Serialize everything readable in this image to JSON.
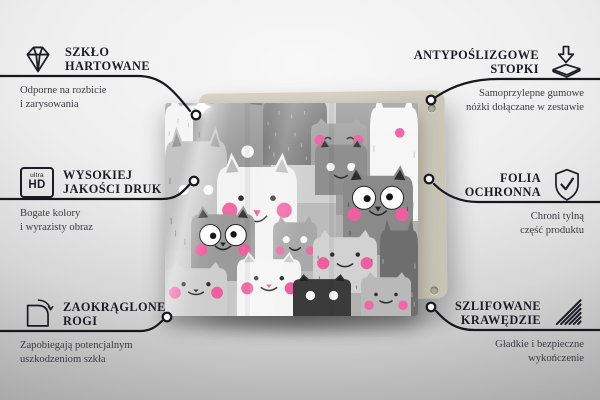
{
  "colors": {
    "title_text": "#1c1c24",
    "subtitle_text": "#3a3a41",
    "callout_line": "#17171c",
    "back_panel": "#d6d2c4",
    "accent_pink": "#ee5f9d",
    "backdrop_top": "#f8f8f8",
    "backdrop_bottom": "#a6a6a6"
  },
  "icons": {
    "ultra_hd": {
      "top": "ultra",
      "bottom": "HD"
    },
    "sparkle_glyph": "✦"
  },
  "features": {
    "left": [
      {
        "icon": "diamond-icon",
        "title_lines": [
          "SZKŁO",
          "HARTOWANE"
        ],
        "subtitle_lines": [
          "Odporne na rozbicie",
          "i zarysowania"
        ]
      },
      {
        "icon": "ultra-hd-icon",
        "title_lines": [
          "WYSOKIEJ",
          "JAKOŚCI DRUK"
        ],
        "subtitle_lines": [
          "Bogate kolory",
          "i wyrazisty obraz"
        ]
      },
      {
        "icon": "rounded-corner-icon",
        "title_lines": [
          "ZAOKRĄGLONE",
          "ROGI"
        ],
        "subtitle_lines": [
          "Zapobiegają potencjalnym",
          "uszkodzeniom szkła"
        ]
      }
    ],
    "right": [
      {
        "icon": "anti-slip-feet-icon",
        "title_lines": [
          "ANTYPOŚLIZGOWE",
          "STOPKI"
        ],
        "subtitle_lines": [
          "Samoprzylepne gumowe",
          "nóżki dołączane w zestawie"
        ]
      },
      {
        "icon": "shield-check-icon",
        "title_lines": [
          "FOLIA",
          "OCHRONNA"
        ],
        "subtitle_lines": [
          "Chroni tylną",
          "część produktu"
        ]
      },
      {
        "icon": "polished-edges-icon",
        "title_lines": [
          "SZLIFOWANE",
          "KRAWĘDZIE"
        ],
        "subtitle_lines": [
          "Gładkie i bezpieczne",
          "wykończenie"
        ]
      }
    ]
  },
  "product": {
    "pattern": {
      "pink": "#ee5f9d",
      "patches": [
        {
          "x": 0,
          "y": 0,
          "w": 253,
          "h": 213,
          "c": "#bcbcbc"
        },
        {
          "x": 0,
          "y": 0,
          "w": 85,
          "h": 92,
          "c": "#a9a9a9"
        },
        {
          "x": 85,
          "y": 0,
          "w": 86,
          "h": 100,
          "c": "#d0d0d0"
        },
        {
          "x": 171,
          "y": 0,
          "w": 82,
          "h": 112,
          "c": "#9e9e9e"
        },
        {
          "x": 0,
          "y": 92,
          "w": 80,
          "h": 121,
          "c": "#c7c7c7"
        },
        {
          "x": 171,
          "y": 112,
          "w": 82,
          "h": 101,
          "c": "#b1b1b1"
        }
      ],
      "cats": [
        {
          "x": 0,
          "y": -6,
          "w": 52,
          "h": 86,
          "c": "#f4f4f4",
          "ink": "#9a9a9a",
          "eyes": "none",
          "fur": true,
          "dense": true
        },
        {
          "x": 28,
          "y": -14,
          "w": 78,
          "h": 108,
          "c": "#9c9c9c",
          "ink": "#2f2f2f",
          "eyes": "whitedot",
          "eyeY": 0.58,
          "mouth": true,
          "fur": true,
          "earIn": "#6e6e6e"
        },
        {
          "x": 98,
          "y": -10,
          "w": 64,
          "h": 72,
          "c": "#7d7d7d",
          "ink": "#e8e8e8",
          "eyes": "none",
          "fur": true,
          "dense": true
        },
        {
          "x": 205,
          "y": -8,
          "w": 48,
          "h": 126,
          "c": "#f6f6f6",
          "ink": "#9a9a9a",
          "eyes": "none",
          "fur": true,
          "pinkdot": [
            0.62,
            0.3
          ]
        },
        {
          "x": 146,
          "y": 16,
          "w": 56,
          "h": 46,
          "c": "#a5a5a5",
          "ink": "#3a3a3a",
          "eyes": "closed",
          "eyeY": 0.42,
          "cheeks": "#ef63a0",
          "cheekY": 0.46
        },
        {
          "x": 150,
          "y": 36,
          "w": 52,
          "h": 56,
          "c": "#8f8f8f",
          "ink": "#2f2f2f",
          "eyes": "whitedot",
          "eyeY": 0.5,
          "mouth": true,
          "earIn": "#3c3c3c"
        },
        {
          "x": 0,
          "y": 26,
          "w": 62,
          "h": 122,
          "c": "#c4c4c4",
          "ink": "#555555",
          "eyes": "whitedot",
          "eyeY": 0.5,
          "fur": true,
          "earIn": "#9a9a9a"
        },
        {
          "x": 52,
          "y": 52,
          "w": 80,
          "h": 120,
          "c": "#f3f3f3",
          "ink": "#2e2e2e",
          "eyes": "dot",
          "eyeY": 0.36,
          "cheeks": "#f06aa5",
          "cheekY": 0.46,
          "nose": "#ef5f9d",
          "mouth": true,
          "earIn": "#bcbcbc"
        },
        {
          "x": 178,
          "y": 64,
          "w": 70,
          "h": 88,
          "c": "#8a8a8a",
          "ink": "#262626",
          "eyes": "googly",
          "eyeY": 0.35,
          "cheeks": "#ee5f9d",
          "cheekY": 0.54,
          "nose": "#262626",
          "mouth": true,
          "earIn": "#2e2e2e",
          "fur": true
        },
        {
          "x": 215,
          "y": 118,
          "w": 38,
          "h": 95,
          "c": "#6e6e6e",
          "ink": "#dedede",
          "eyes": "none",
          "fur": true
        },
        {
          "x": 26,
          "y": 104,
          "w": 64,
          "h": 74,
          "c": "#9b9b9b",
          "ink": "#242424",
          "eyes": "googly",
          "eyeY": 0.38,
          "cheeks": "#ee5f9d",
          "cheekY": 0.58,
          "nose": "#242424",
          "mouth": true,
          "earIn": "#3a3a3a"
        },
        {
          "x": 108,
          "y": 114,
          "w": 44,
          "h": 54,
          "c": "#a9a9a9",
          "ink": "#2c2c2c",
          "eyes": "whitedot",
          "eyeY": 0.42,
          "cheeks": "#ef6aa2",
          "cheekY": 0.62,
          "mouth": true
        },
        {
          "x": 148,
          "y": 128,
          "w": 64,
          "h": 62,
          "c": "#d2d2d2",
          "ink": "#2e2e2e",
          "eyes": "dot",
          "eyeY": 0.38,
          "cheeks": "#ee5f9d",
          "cheekY": 0.52,
          "mouth": true,
          "fur": true
        },
        {
          "x": 0,
          "y": 160,
          "w": 62,
          "h": 53,
          "c": "#cecece",
          "ink": "#2f2f2f",
          "eyes": "dot",
          "eyeY": 0.4,
          "cheeks": "#ee5f9d",
          "cheekY": 0.56,
          "nose": "#2f2f2f",
          "mouth": true
        },
        {
          "x": 72,
          "y": 150,
          "w": 64,
          "h": 63,
          "c": "#f5f5f5",
          "ink": "#2d2d2d",
          "eyes": "dot",
          "eyeY": 0.4,
          "cheeks": "#ee5f9d",
          "cheekY": 0.56,
          "nose": "#ef5f9d",
          "mouth": true,
          "earIn": "#cfcfcf"
        },
        {
          "x": 128,
          "y": 172,
          "w": 58,
          "h": 41,
          "c": "#3b3b3b",
          "ink": "#f1f1f1",
          "eyes": "whitedot",
          "eyeY": 0.5,
          "earIn": "#222222"
        },
        {
          "x": 196,
          "y": 170,
          "w": 50,
          "h": 43,
          "c": "#b9b9b9",
          "ink": "#2e2e2e",
          "eyes": "dot",
          "eyeY": 0.5,
          "cheeks": "#ef6aa2",
          "cheekY": 0.75,
          "mouth": true
        }
      ]
    }
  }
}
